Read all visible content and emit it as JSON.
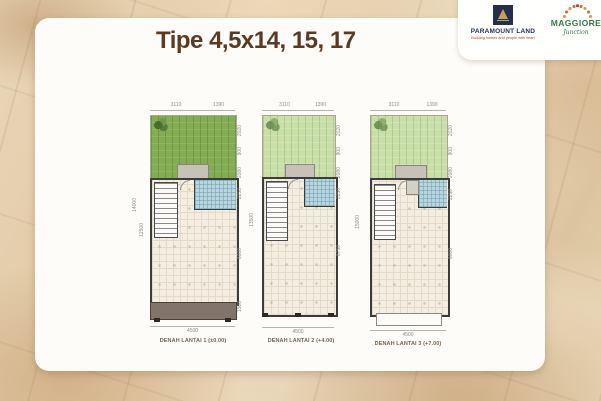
{
  "title": "Tipe 4,5x14, 15, 17",
  "logos": {
    "paramount_land": {
      "name": "PARAMOUNT LAND",
      "tagline": "Building homes and people with heart",
      "icon": "gold-triangle-on-navy-square"
    },
    "maggiore": {
      "name": "MAGGIORE",
      "subname": "Junction",
      "icon": "orange-sunburst-dots"
    }
  },
  "plans": [
    {
      "caption": "DENAH LANTAI 1 (±0.00)",
      "areas": [
        "garden",
        "porch",
        "stairs",
        "bathroom",
        "living-area",
        "carport"
      ],
      "dims": {
        "top": [
          "3110",
          "1390"
        ],
        "bottom": "4500",
        "left": [
          "14000",
          "12500"
        ],
        "right": [
          "2020",
          "900",
          "2080",
          "2250",
          "6000",
          "1500"
        ]
      }
    },
    {
      "caption": "DENAH LANTAI 2 (+4.00)",
      "areas": [
        "void-garden",
        "balcony",
        "stairs",
        "bathroom",
        "bedroom-area"
      ],
      "dims": {
        "top": [
          "3110",
          "1390"
        ],
        "bottom": "4500",
        "left": [
          "13500"
        ],
        "right": [
          "2020",
          "900",
          "2080",
          "2250",
          "6750"
        ]
      }
    },
    {
      "caption": "DENAH LANTAI 3 (+7.00)",
      "areas": [
        "roof-garden",
        "planter",
        "stairs",
        "bathroom",
        "bedroom-area",
        "balcony"
      ],
      "dims": {
        "top": [
          "3110",
          "1390"
        ],
        "bottom": "4500",
        "left": [
          "15000"
        ],
        "right": [
          "2020",
          "900",
          "2080",
          "2250",
          "6000"
        ]
      }
    }
  ],
  "colors": {
    "background_marble": "#e7d4b6",
    "card": "#fdfcf9",
    "title_text": "#5c3a20",
    "garden_green": "#83ad52",
    "garden_light_green": "#c9dfa8",
    "floor_tile": "#f4eee2",
    "bathroom_tile": "#b7d6dd",
    "carport": "#82746a",
    "paramount_navy": "#22304f",
    "paramount_gold": "#c9a04c",
    "paramount_red": "#c23b2e",
    "maggiore_green": "#2e7d3f",
    "maggiore_orange": "#e09b3d",
    "dim_text": "#8d8d8d",
    "caption_text": "#77624c"
  }
}
